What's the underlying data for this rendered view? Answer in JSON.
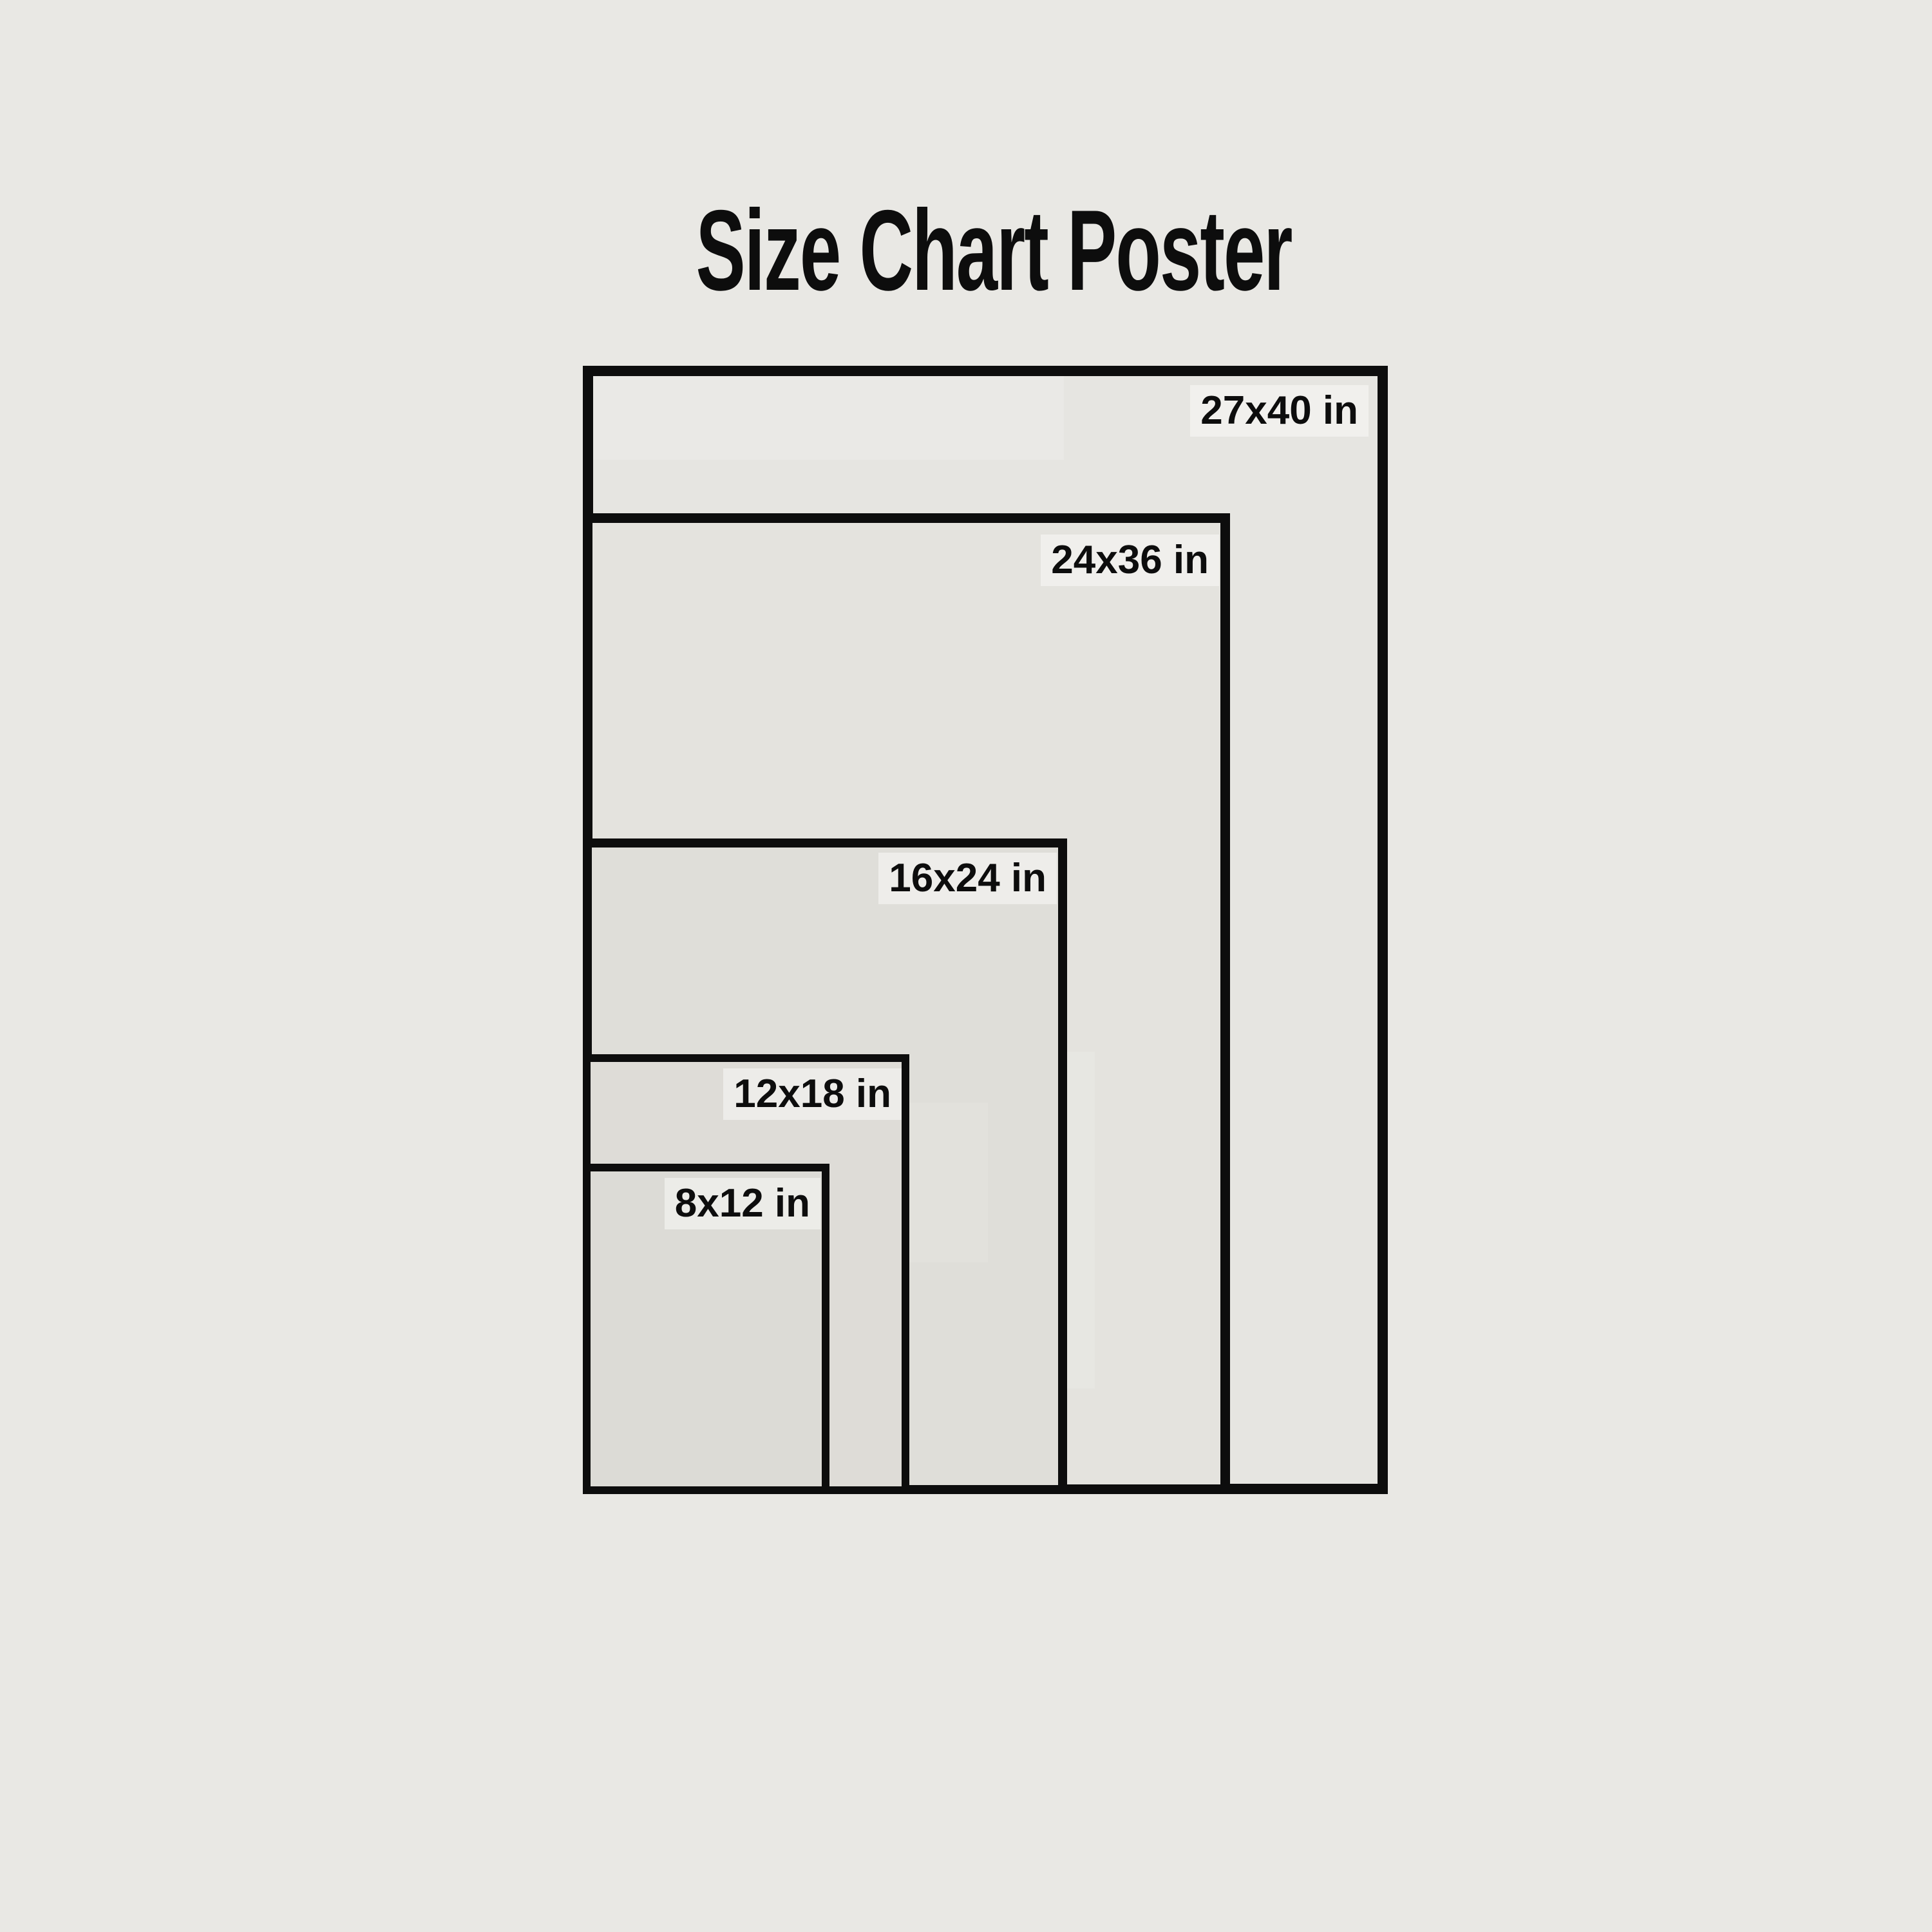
{
  "page": {
    "title": "Size Chart Poster"
  },
  "colors": {
    "background": "#e9e8e4",
    "line": "#0d0d0d",
    "text": "#0d0d0d",
    "fill_27x40": "#e6e5e1",
    "fill_24x36": "#e4e3de",
    "fill_16x24": "#dfded9",
    "fill_12x18": "#dedcd7",
    "fill_8x12": "#dcdbd6"
  },
  "sizes": [
    {
      "label": "27x40 in",
      "width_in": 27,
      "height_in": 40
    },
    {
      "label": "24x36 in",
      "width_in": 24,
      "height_in": 36
    },
    {
      "label": "16x24 in",
      "width_in": 16,
      "height_in": 24
    },
    {
      "label": "12x18 in",
      "width_in": 12,
      "height_in": 18
    },
    {
      "label": "8x12 in",
      "width_in": 8,
      "height_in": 12
    }
  ]
}
